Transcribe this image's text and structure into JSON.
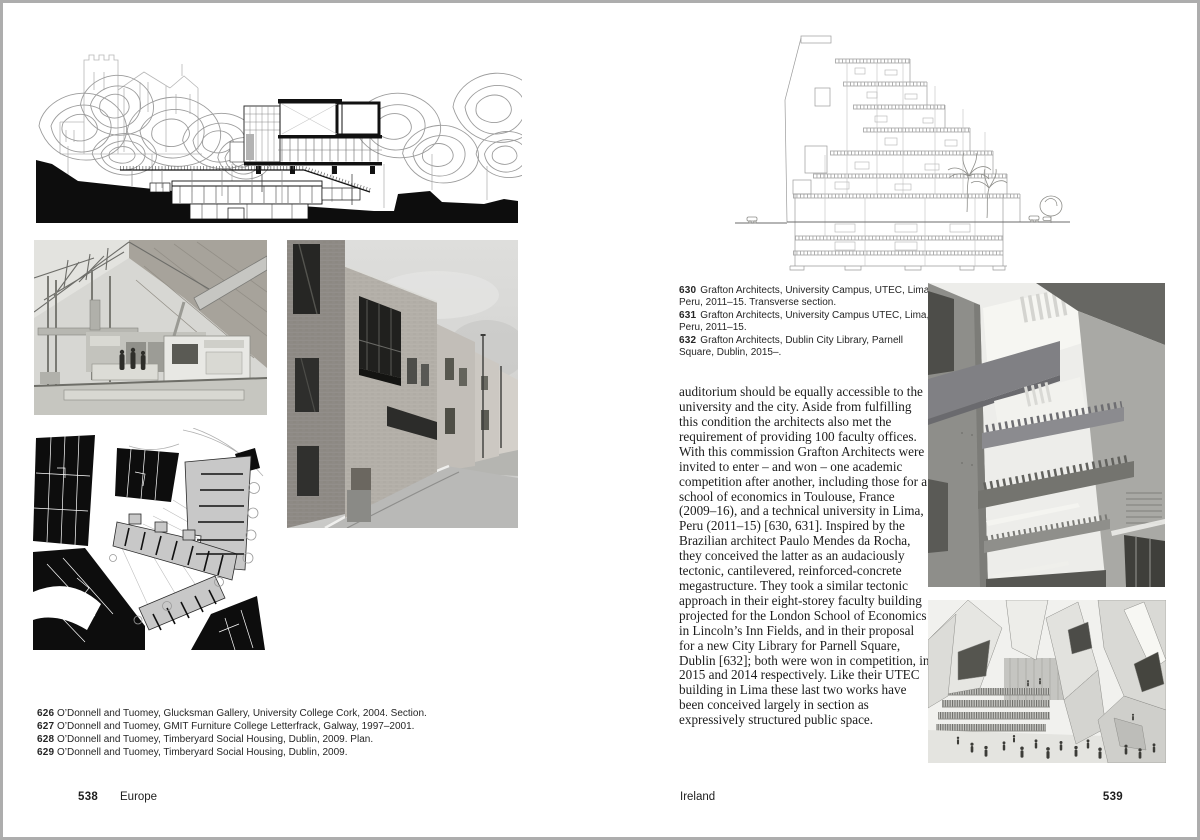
{
  "colors": {
    "paper": "#ffffff",
    "ink": "#1e1e1e",
    "caption_ink": "#262626",
    "page_edge": "#adadad"
  },
  "left_page": {
    "footer": {
      "page_number": "538",
      "section": "Europe"
    },
    "captions": [
      {
        "num": "626",
        "text": "O’Donnell and Tuomey, Glucksman Gallery, University College Cork, 2004. Section."
      },
      {
        "num": "627",
        "text": "O’Donnell and Tuomey, GMIT Furniture College Letterfrack, Galway, 1997–2001."
      },
      {
        "num": "628",
        "text": "O’Donnell and Tuomey, Timberyard Social Housing, Dublin, 2009. Plan."
      },
      {
        "num": "629",
        "text": "O’Donnell and Tuomey, Timberyard Social Housing, Dublin, 2009."
      }
    ]
  },
  "right_page": {
    "footer": {
      "page_number": "539",
      "section": "Ireland"
    },
    "captions": [
      {
        "num": "630",
        "text": "Grafton Architects, University Campus, UTEC, Lima, Peru, 2011–15. Transverse section."
      },
      {
        "num": "631",
        "text": "Grafton Architects, University Campus UTEC, Lima, Peru, 2011–15."
      },
      {
        "num": "632",
        "text": "Grafton Architects, Dublin City Library, Parnell Square, Dublin, 2015–."
      }
    ],
    "body_text": "auditorium should be equally accessible to the university and the city. Aside from fulfilling this condition the architects also met the requirement of providing 100 faculty offices. With this commission Grafton Architects were invited to enter – and won – one academic competition after another, including those for a school of economics in Toulouse, France (2009–16), and a technical university in Lima, Peru (2011–15) [630, 631]. Inspired by the Brazilian architect Paulo Mendes da Rocha, they conceived the latter as an audaciously tectonic, cantilevered, reinforced-concrete megastructure. They took a similar tectonic approach in their eight-storey faculty building projected for the London School of Economics in Lincoln’s Inn Fields, and in their proposal for a new City Library for Parnell Square, Dublin [632]; both were won in competition, in 2015 and 2014 respectively. Like their UTEC building in Lima these last two works have been conceived largely in section as expressively structured public space."
  }
}
